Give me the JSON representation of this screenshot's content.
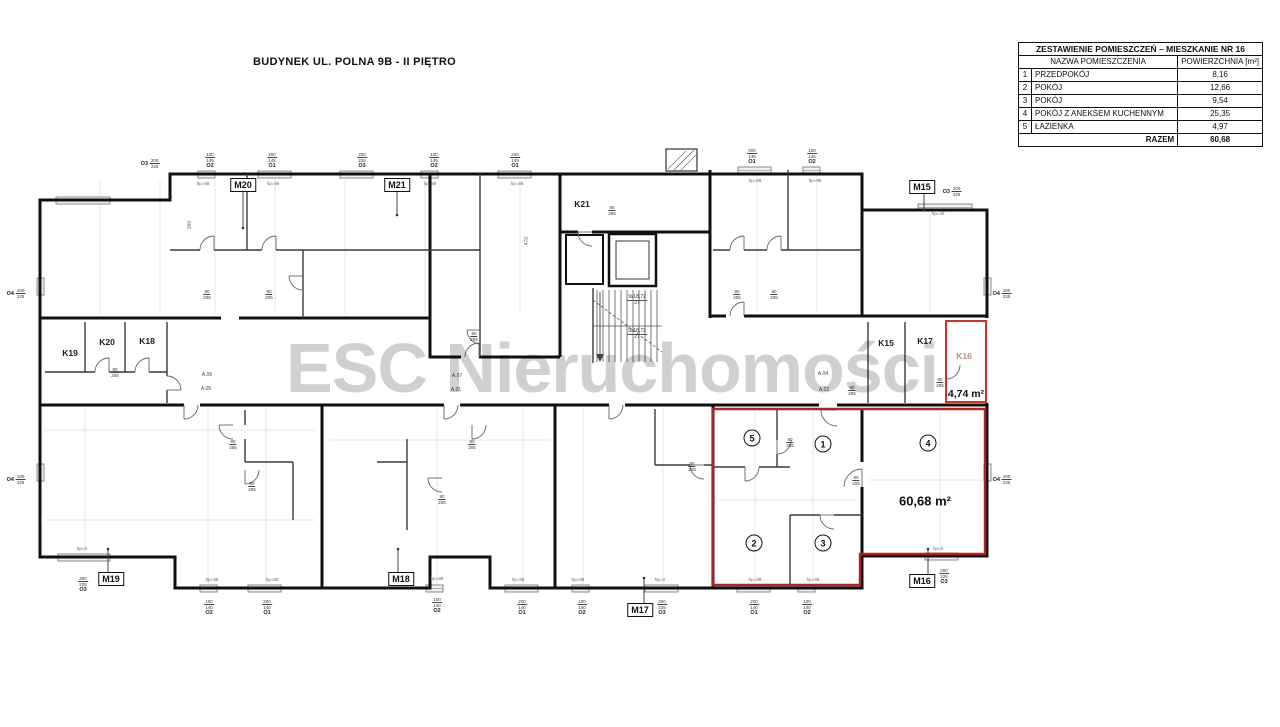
{
  "title": "BUDYNEK UL. POLNA 9B - II PIĘTRO",
  "watermark": "ESC Nieruchomości",
  "summary_table": {
    "title": "ZESTAWIENIE POMIESZCZEŃ – MIESZKANIE NR 16",
    "col_name": "NAZWA POMIESZCZENIA",
    "col_area": "POWIERZCHNIA [m²]",
    "rows": [
      {
        "no": "1",
        "name": "PRZEDPOKÓJ",
        "area": "8,16"
      },
      {
        "no": "2",
        "name": "POKÓJ",
        "area": "12,66"
      },
      {
        "no": "3",
        "name": "POKÓJ",
        "area": "9,54"
      },
      {
        "no": "4",
        "name": "POKÓJ Z ANEKSEM KUCHENNYM",
        "area": "25,35"
      },
      {
        "no": "5",
        "name": "ŁAZIENKA",
        "area": "4,97"
      }
    ],
    "total_label": "RAZEM",
    "total_value": "60,68"
  },
  "plan": {
    "highlight_color": "#b22222",
    "storage_highlight_color": "#c0392b",
    "apartment_tags": [
      {
        "label": "M20",
        "x": 243,
        "y": 185
      },
      {
        "label": "M21",
        "x": 397,
        "y": 185
      },
      {
        "label": "M15",
        "x": 922,
        "y": 187
      },
      {
        "label": "M19",
        "x": 111,
        "y": 579
      },
      {
        "label": "M18",
        "x": 401,
        "y": 579
      },
      {
        "label": "M17",
        "x": 640,
        "y": 610
      },
      {
        "label": "M16",
        "x": 922,
        "y": 581
      }
    ],
    "storage_tags": [
      {
        "label": "K19",
        "x": 70,
        "y": 353,
        "muted": false
      },
      {
        "label": "K20",
        "x": 107,
        "y": 342,
        "muted": false
      },
      {
        "label": "K18",
        "x": 147,
        "y": 341,
        "muted": false
      },
      {
        "label": "K21",
        "x": 582,
        "y": 204,
        "muted": false
      },
      {
        "label": "K15",
        "x": 886,
        "y": 343,
        "muted": false
      },
      {
        "label": "K17",
        "x": 925,
        "y": 341,
        "muted": false
      },
      {
        "label": "K16",
        "x": 964,
        "y": 356,
        "muted": true
      }
    ],
    "room_markers": [
      {
        "n": "5",
        "x": 752,
        "y": 438
      },
      {
        "n": "1",
        "x": 823,
        "y": 444
      },
      {
        "n": "4",
        "x": 928,
        "y": 443
      },
      {
        "n": "2",
        "x": 754,
        "y": 543
      },
      {
        "n": "3",
        "x": 823,
        "y": 543
      }
    ],
    "area_labels": [
      {
        "text": "60,68 m²",
        "x": 925,
        "y": 501,
        "size": 13
      },
      {
        "text": "4,74 m²",
        "x": 966,
        "y": 394,
        "size": 10.5
      }
    ],
    "window_tags": [
      {
        "name": "O3",
        "dims": "200/225",
        "x": 150,
        "y": 158,
        "stack": false
      },
      {
        "name": "O2",
        "dims": "100/145",
        "x": 210,
        "y": 152,
        "stack": true
      },
      {
        "name": "O1",
        "dims": "200/145",
        "x": 272,
        "y": 152,
        "stack": true
      },
      {
        "name": "O3",
        "dims": "200/225",
        "x": 362,
        "y": 152,
        "stack": true
      },
      {
        "name": "O2",
        "dims": "100/145",
        "x": 434,
        "y": 152,
        "stack": true
      },
      {
        "name": "O1",
        "dims": "200/145",
        "x": 515,
        "y": 152,
        "stack": true
      },
      {
        "name": "O1",
        "dims": "200/145",
        "x": 752,
        "y": 148,
        "stack": true
      },
      {
        "name": "O2",
        "dims": "100/145",
        "x": 812,
        "y": 148,
        "stack": true
      },
      {
        "name": "O3",
        "dims": "200/225",
        "x": 952,
        "y": 186,
        "stack": false
      },
      {
        "name": "O4",
        "dims": "100/225",
        "x": 16,
        "y": 288,
        "stack": false
      },
      {
        "name": "O4",
        "dims": "100/225",
        "x": 16,
        "y": 474,
        "stack": false
      },
      {
        "name": "O4",
        "dims": "100/225",
        "x": 1002,
        "y": 288,
        "stack": false
      },
      {
        "name": "O4",
        "dims": "100/225",
        "x": 1002,
        "y": 474,
        "stack": false
      },
      {
        "name": "O3",
        "dims": "200/225",
        "x": 83,
        "y": 576,
        "stack": true
      },
      {
        "name": "O2",
        "dims": "100/140",
        "x": 209,
        "y": 599,
        "stack": true
      },
      {
        "name": "O1",
        "dims": "200/140",
        "x": 267,
        "y": 599,
        "stack": true
      },
      {
        "name": "O2",
        "dims": "100/140",
        "x": 437,
        "y": 597,
        "stack": true
      },
      {
        "name": "O1",
        "dims": "200/140",
        "x": 522,
        "y": 599,
        "stack": true
      },
      {
        "name": "O2",
        "dims": "100/140",
        "x": 582,
        "y": 599,
        "stack": true
      },
      {
        "name": "O3",
        "dims": "200/225",
        "x": 662,
        "y": 599,
        "stack": true
      },
      {
        "name": "O1",
        "dims": "200/140",
        "x": 754,
        "y": 599,
        "stack": true
      },
      {
        "name": "O2",
        "dims": "100/140",
        "x": 807,
        "y": 599,
        "stack": true
      },
      {
        "name": "O3",
        "dims": "200/225",
        "x": 944,
        "y": 568,
        "stack": true
      }
    ],
    "door_dim": {
      "w": "80",
      "h": "205"
    },
    "door_dim_positions": [
      {
        "x": 207,
        "y": 280
      },
      {
        "x": 269,
        "y": 280
      },
      {
        "x": 474,
        "y": 322
      },
      {
        "x": 612,
        "y": 196
      },
      {
        "x": 737,
        "y": 280
      },
      {
        "x": 774,
        "y": 280
      },
      {
        "x": 233,
        "y": 430
      },
      {
        "x": 252,
        "y": 472
      },
      {
        "x": 472,
        "y": 430
      },
      {
        "x": 442,
        "y": 485
      },
      {
        "x": 790,
        "y": 428
      },
      {
        "x": 852,
        "y": 376
      },
      {
        "x": 856,
        "y": 466
      },
      {
        "x": 115,
        "y": 358
      },
      {
        "x": 940,
        "y": 368
      },
      {
        "x": 692,
        "y": 452
      }
    ],
    "sill_tags": [
      {
        "text": "hp=88",
        "x": 203,
        "y": 181
      },
      {
        "text": "hp=88",
        "x": 273,
        "y": 181
      },
      {
        "text": "hp=88",
        "x": 430,
        "y": 181
      },
      {
        "text": "hp=88",
        "x": 517,
        "y": 181
      },
      {
        "text": "hp=88",
        "x": 755,
        "y": 178
      },
      {
        "text": "hp=88",
        "x": 815,
        "y": 178
      },
      {
        "text": "hp=40",
        "x": 938,
        "y": 211
      },
      {
        "text": "hp=0",
        "x": 82,
        "y": 546
      },
      {
        "text": "hp=88",
        "x": 212,
        "y": 577
      },
      {
        "text": "hp=88",
        "x": 272,
        "y": 577
      },
      {
        "text": "hp=88",
        "x": 437,
        "y": 576
      },
      {
        "text": "hp=88",
        "x": 518,
        "y": 577
      },
      {
        "text": "hp=88",
        "x": 578,
        "y": 577
      },
      {
        "text": "hp=0",
        "x": 660,
        "y": 577
      },
      {
        "text": "hp=88",
        "x": 755,
        "y": 577
      },
      {
        "text": "hp=88",
        "x": 813,
        "y": 577
      },
      {
        "text": "hp=0",
        "x": 938,
        "y": 546
      }
    ],
    "stair_note": {
      "line1": "9x18,72",
      "line2": "27",
      "positions": [
        {
          "x": 637,
          "y": 294
        },
        {
          "x": 637,
          "y": 328
        }
      ]
    },
    "unit_refs": [
      {
        "text": "A.06",
        "x": 207,
        "y": 372
      },
      {
        "text": "A.05",
        "x": 206,
        "y": 386
      },
      {
        "text": "A.07",
        "x": 457,
        "y": 373
      },
      {
        "text": "A.01",
        "x": 456,
        "y": 387
      },
      {
        "text": "A.04",
        "x": 823,
        "y": 371
      },
      {
        "text": "A.02",
        "x": 824,
        "y": 387
      }
    ],
    "misc_dims": [
      {
        "text": "470",
        "x": 527,
        "y": 241
      },
      {
        "text": "360",
        "x": 190,
        "y": 225
      }
    ]
  }
}
